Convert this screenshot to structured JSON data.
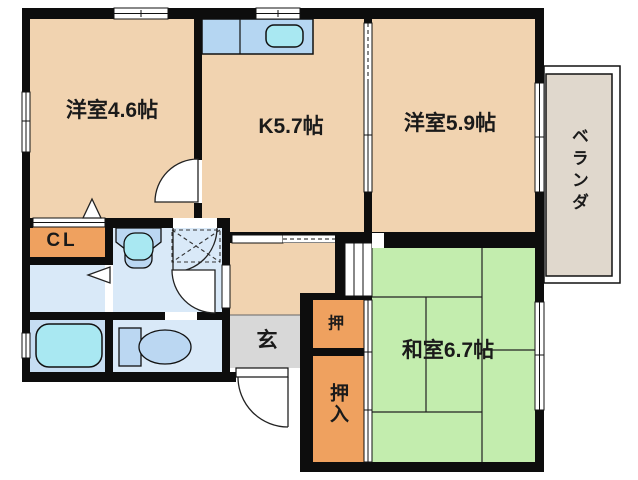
{
  "title": "apartment-floor-plan",
  "rooms": {
    "western1": {
      "label": "洋室4.6帖"
    },
    "kitchen": {
      "label": "K5.7帖"
    },
    "western2": {
      "label": "洋室5.9帖"
    },
    "washitsu": {
      "label": "和室6.7帖"
    },
    "veranda": {
      "label": "ベランダ"
    },
    "closet_cl": {
      "label": "CL"
    },
    "genkan": {
      "label": "玄"
    },
    "oshi": {
      "label": "押"
    },
    "oshiire": {
      "label": "押入"
    }
  },
  "fixtures": {
    "kitchen_sink": "kitchen-counter-with-sink",
    "wash_basin": "washbasin",
    "washer_pan": "washing-machine-pan",
    "bathtub": "bathtub",
    "toilet": "toilet"
  },
  "colors": {
    "wall": "#0d0d0d",
    "room_peach": "#F1D3B0",
    "tatami_green": "#C3EDAE",
    "closet_orange": "#EFA15F",
    "genkan_gray": "#D8D8D8",
    "veranda_gray": "#E0D8CD",
    "water_blue": "#D9E9F8",
    "bath_blue": "#C6DDF2",
    "counter_blue": "#B5D6F2",
    "sink_cyan": "#A9E8F2",
    "fixture_blue": "#BBD7F2"
  }
}
